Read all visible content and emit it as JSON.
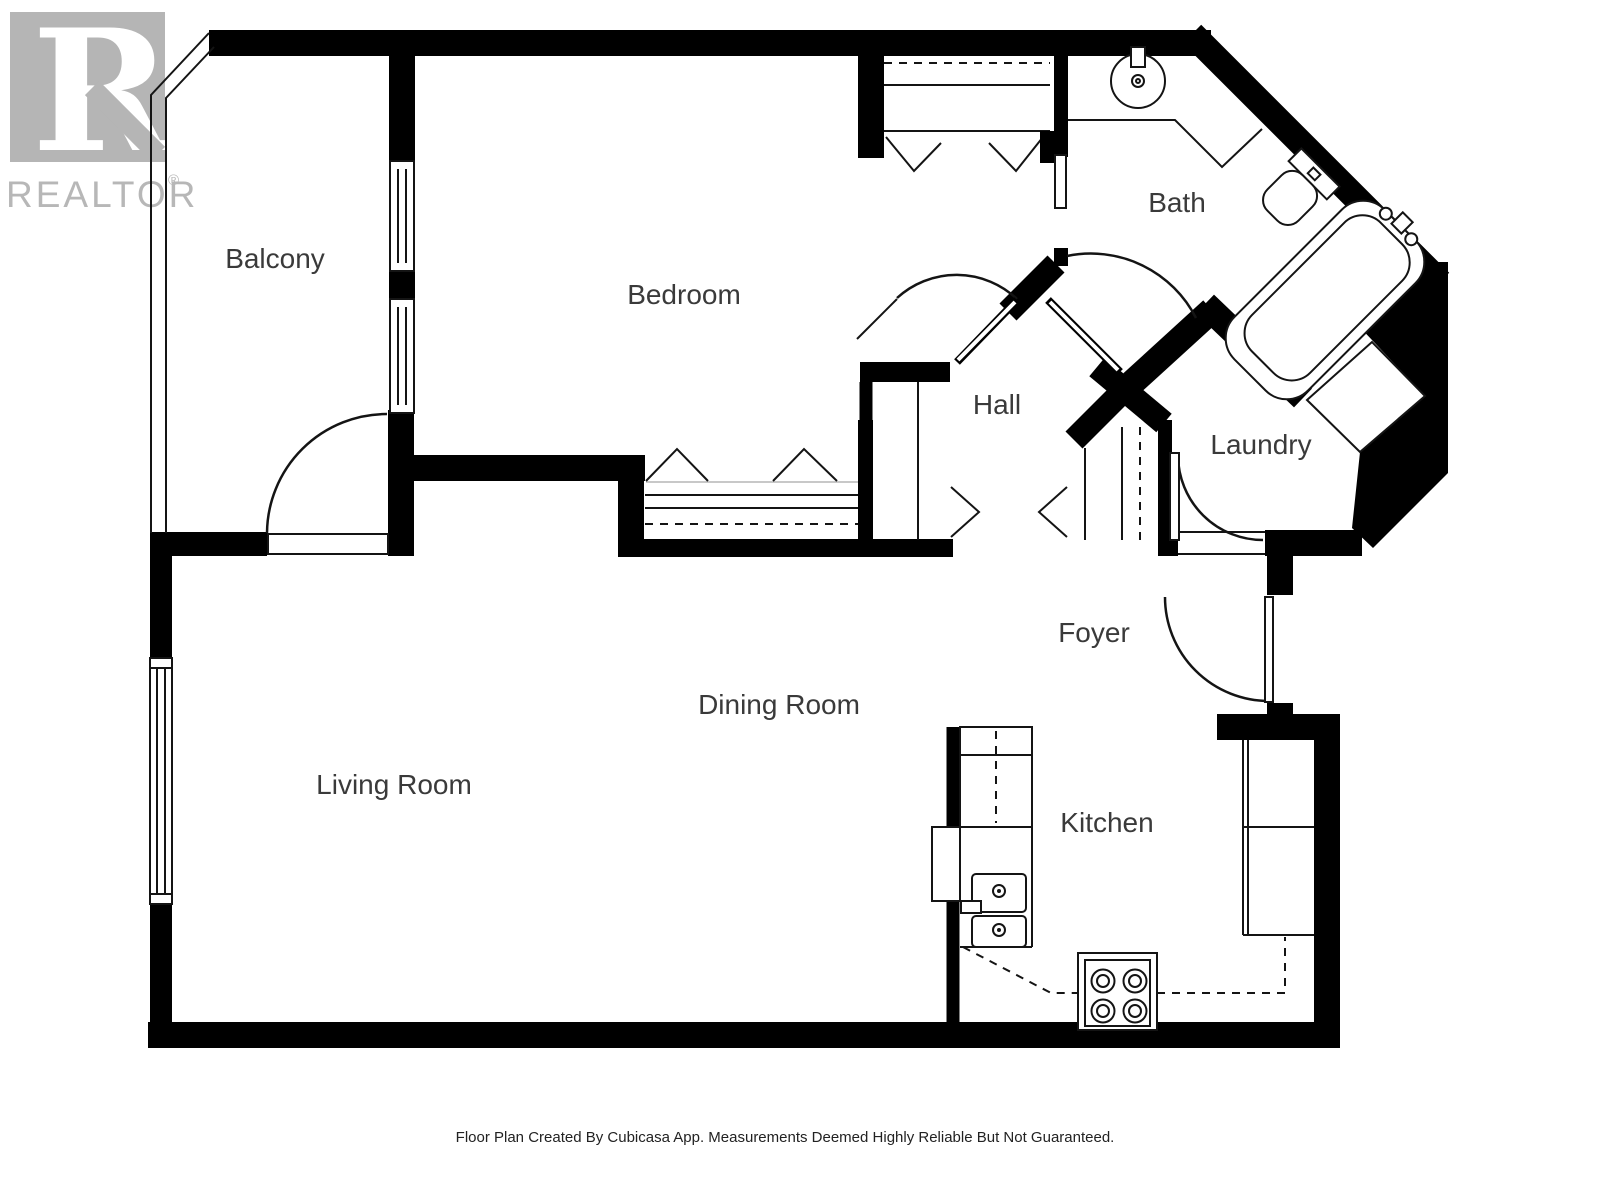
{
  "branding": {
    "logo_letter": "R",
    "logo_wordmark": "REALTOR",
    "registered_mark": "®",
    "logo_gray": "#b5b5b5"
  },
  "rooms": {
    "balcony": {
      "label": "Balcony"
    },
    "bedroom": {
      "label": "Bedroom"
    },
    "bath": {
      "label": "Bath"
    },
    "hall": {
      "label": "Hall"
    },
    "laundry": {
      "label": "Laundry"
    },
    "foyer": {
      "label": "Foyer"
    },
    "dining_room": {
      "label": "Dining Room"
    },
    "living_room": {
      "label": "Living Room"
    },
    "kitchen": {
      "label": "Kitchen"
    }
  },
  "footer": {
    "disclaimer": "Floor Plan Created By Cubicasa App. Measurements Deemed Highly Reliable But Not Guaranteed."
  },
  "colors": {
    "wall": "#000000",
    "line": "#141414",
    "label_text": "#3a3a3a",
    "logo_gray": "#b5b5b5"
  }
}
